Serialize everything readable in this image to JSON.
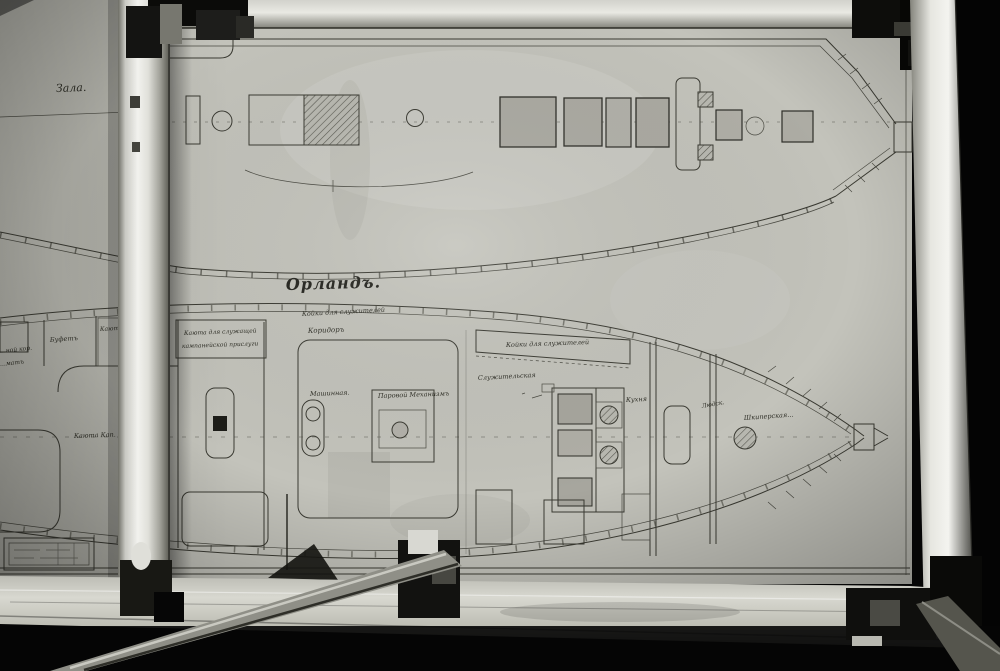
{
  "photo": {
    "subject": "archival photograph of a ship deck plan drawing held in a metal frame",
    "colors": {
      "background": "#050505",
      "paper": "#c3c3bb",
      "ink": "#3a3a32",
      "frame_highlight": "#f2f2ee",
      "frame_shadow": "#5c5c54"
    }
  },
  "upper_plan": {
    "room_label": "Зала."
  },
  "title": {
    "ship_name": "Орландъ."
  },
  "lower_plan": {
    "labels": {
      "koyki_top": "Койки для служителей",
      "koridor": "Коридоръ",
      "kayuta_sluzh_1": "Каюта для служащей",
      "kayuta_sluzh_2": "кампанейской прислуги",
      "kayuta_partial": "Каюта",
      "bufet": "Буфетъ",
      "stern_frag_1": "…ной кор.",
      "stern_frag_2": "…матъ",
      "kayuta_kap": "Каюта Кап.",
      "mashinnaya": "Машинная.",
      "parovoy": "Паровой Механизмъ",
      "sluzhitelskaya": "Служительская",
      "koyki_slanted": "Койки для служителей",
      "kuhnya": "Кухня",
      "ludskoy": "Людск.",
      "shkiperskaya": "Шкиперская…"
    }
  }
}
